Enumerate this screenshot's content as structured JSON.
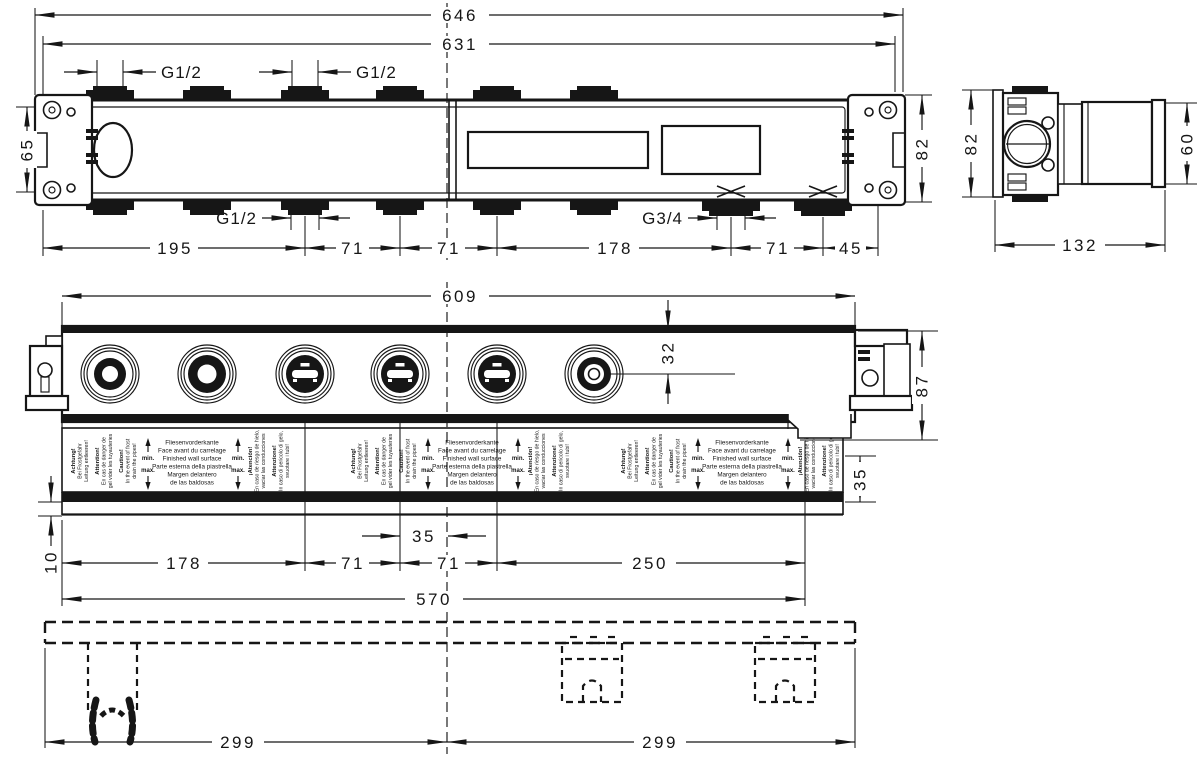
{
  "dims": {
    "top": {
      "overall": "646",
      "inner": "631",
      "left_height": "65",
      "right_height": "82",
      "thread_top_1": "G1/2",
      "thread_top_2": "G1/2",
      "thread_bottom_left": "G1/2",
      "thread_bottom_right": "G3/4",
      "chain": [
        "195",
        "71",
        "71",
        "178",
        "71",
        "45"
      ]
    },
    "side": {
      "height": "82",
      "right_height": "60",
      "depth": "132"
    },
    "front": {
      "overall": "609",
      "port_offset": "32",
      "right_height": "87",
      "tile_band": "35",
      "plate": "10",
      "center_offset": "35",
      "chain": [
        "178",
        "71",
        "71",
        "250"
      ],
      "body": "570"
    },
    "bottom": {
      "left": "299",
      "right": "299"
    }
  },
  "warning_label": {
    "de": {
      "title": "Achtung!",
      "line1": "Bei Frostgefahr",
      "line2": "Leitung entleeren!"
    },
    "fr": {
      "title": "Attention!",
      "line1": "En cas de danger de",
      "line2": "gel vider les tuyauteries"
    },
    "en": {
      "title": "Caution!",
      "line1": "In the event of frost",
      "line2": "drain the pipes!"
    },
    "min": "min.",
    "max": "max.",
    "wall_face": [
      "Fliesenvorderkante",
      "Face avant du carrelage",
      "Finished wall surface",
      "Parte esterna della piastrella",
      "Margen delantero",
      "de las baldosas"
    ],
    "es": {
      "title": "¡Atención!",
      "line1": "En caso de riesgo de hielo,",
      "line2": "vaciar las conducciones"
    },
    "it": {
      "title": "Attenzione!",
      "line1": "In caso di pericolo di gelo,",
      "line2": "svuotare i tubi!"
    }
  },
  "colors": {
    "ink": "#161616",
    "paper": "#ffffff"
  }
}
